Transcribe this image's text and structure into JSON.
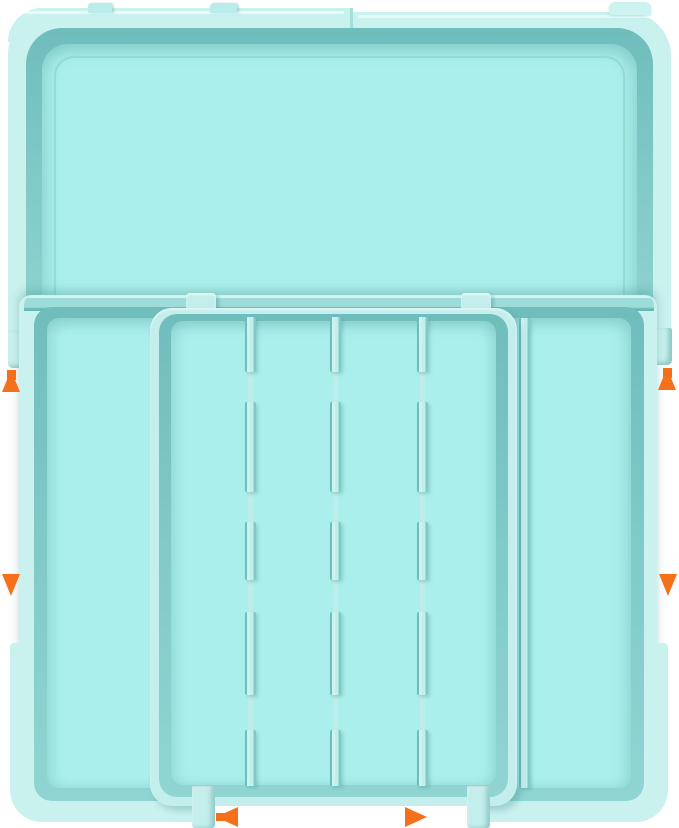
{
  "image_type": "product-illustration",
  "subject": "expandable-drawer-organizer-tray",
  "colors": {
    "background": "#ffffff",
    "shell_light": "#c9f1ee",
    "tray_light": "#c3eeeb",
    "surface": "#abefec",
    "bar_mid": "#9edcda",
    "rim_top": "#6fbdbc",
    "rim_mid": "#7fc9c7",
    "rim_bottom": "#90d5d2",
    "edge_shadow": "#67b7b5",
    "highlight": "#dff8f6",
    "arrow_orange": "#f4701a"
  },
  "structure": {
    "upper_tray_compartments": 1,
    "inner_tray_columns": 4,
    "inner_tray_dividers": 3,
    "side_columns": 2
  },
  "arrows": [
    {
      "id": "up-left",
      "direction": "up",
      "position": "left-side"
    },
    {
      "id": "down-left",
      "direction": "down",
      "position": "left-side"
    },
    {
      "id": "up-right",
      "direction": "up",
      "position": "right-side"
    },
    {
      "id": "down-right",
      "direction": "down",
      "position": "right-side"
    },
    {
      "id": "left-bottom",
      "direction": "left",
      "position": "bottom-center"
    },
    {
      "id": "right-bottom",
      "direction": "right",
      "position": "bottom-center"
    }
  ]
}
